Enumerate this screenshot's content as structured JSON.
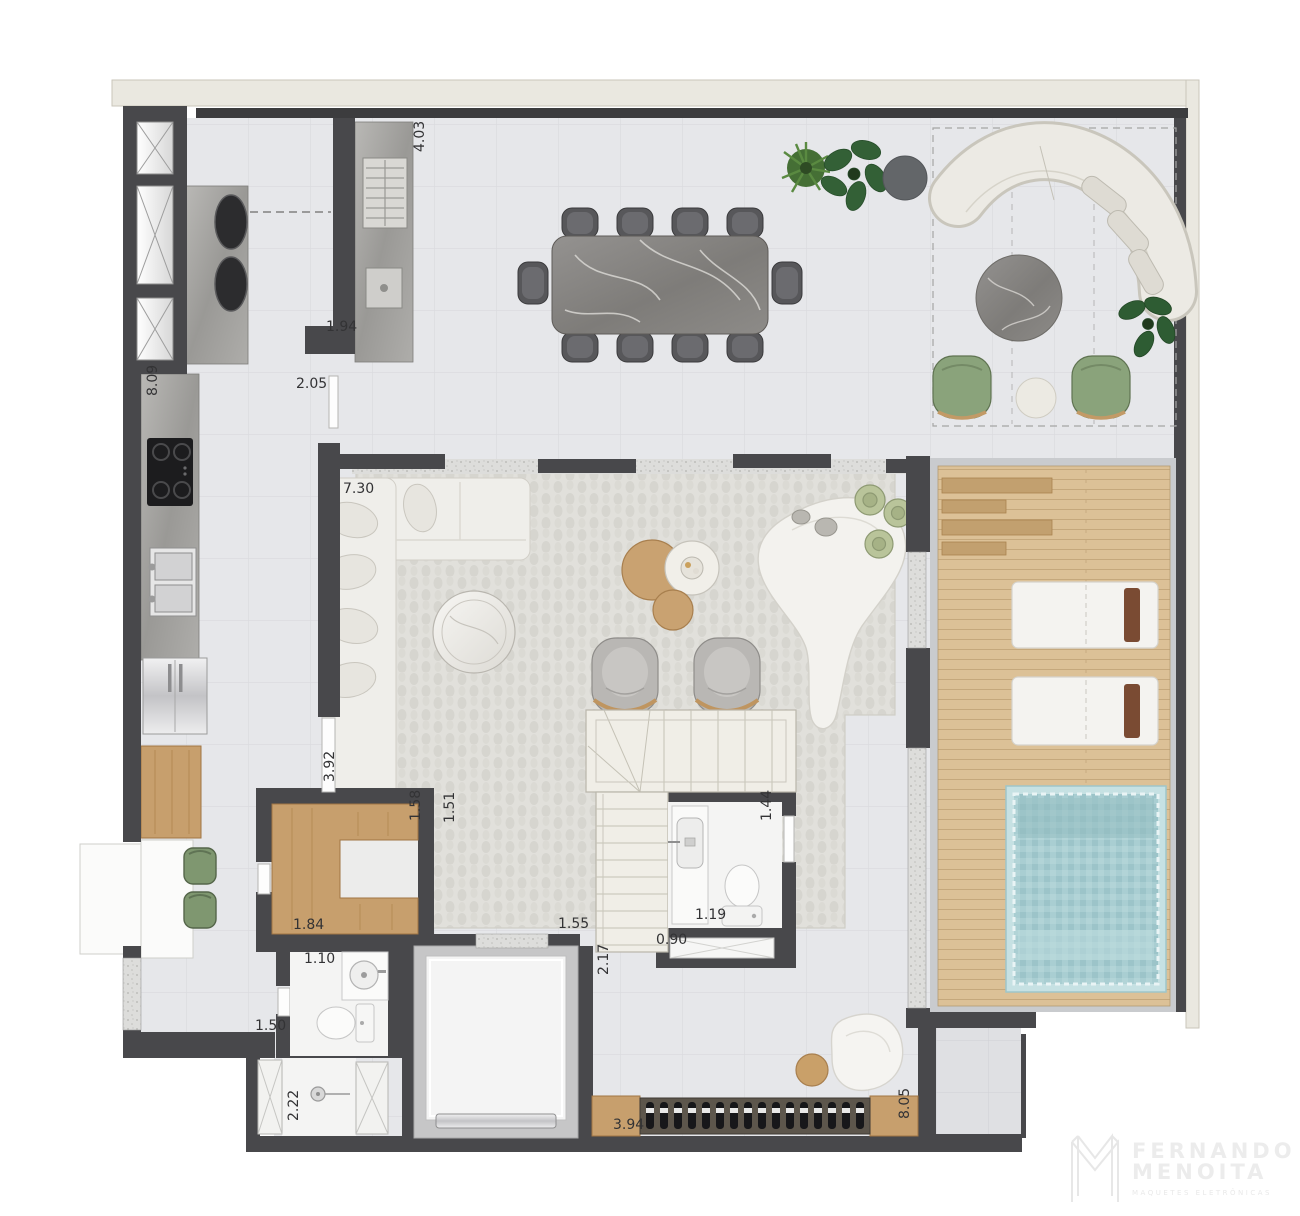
{
  "plan": {
    "type": "residential-floor-plan",
    "dimensions": [
      {
        "text": "4.03",
        "x": 424,
        "y": 152,
        "rot": -90
      },
      {
        "text": "1.94",
        "x": 326,
        "y": 331,
        "rot": 0
      },
      {
        "text": "2.05",
        "x": 296,
        "y": 388,
        "rot": 0
      },
      {
        "text": "8.09",
        "x": 157,
        "y": 396,
        "rot": -90
      },
      {
        "text": "7.30",
        "x": 343,
        "y": 493,
        "rot": 0
      },
      {
        "text": "3.92",
        "x": 334,
        "y": 782,
        "rot": -90
      },
      {
        "text": "1.58",
        "x": 420,
        "y": 821,
        "rot": -90
      },
      {
        "text": "1.51",
        "x": 454,
        "y": 823,
        "rot": -90
      },
      {
        "text": "1.84",
        "x": 293,
        "y": 929,
        "rot": 0
      },
      {
        "text": "1.10",
        "x": 304,
        "y": 963,
        "rot": 0
      },
      {
        "text": "1.50",
        "x": 255,
        "y": 1030,
        "rot": 0
      },
      {
        "text": "2.22",
        "x": 298,
        "y": 1121,
        "rot": -90
      },
      {
        "text": "1.55",
        "x": 558,
        "y": 928,
        "rot": 0
      },
      {
        "text": "0.90",
        "x": 656,
        "y": 944,
        "rot": 0
      },
      {
        "text": "2.17",
        "x": 608,
        "y": 975,
        "rot": -90
      },
      {
        "text": "1.19",
        "x": 695,
        "y": 919,
        "rot": 0
      },
      {
        "text": "1.44",
        "x": 771,
        "y": 821,
        "rot": -90
      },
      {
        "text": "3.94",
        "x": 613,
        "y": 1129,
        "rot": 0
      },
      {
        "text": "8.05",
        "x": 909,
        "y": 1119,
        "rot": -90
      }
    ]
  },
  "logo": {
    "monogram": "M",
    "name": "FERNANDO",
    "surname": "MENOITA",
    "tagline": "maquetes eletrônicas"
  },
  "colors": {
    "wall": "#48484b",
    "floor": "#e6e7ea",
    "exterior_band": "#eae8e0",
    "wood": "#c79f6d",
    "deck": "#dcc197",
    "pool": "#a9ced2",
    "rug": "#e1e0db",
    "sofa": "#eceae4",
    "green_chair": "#8aa37b",
    "label": "#333335"
  }
}
